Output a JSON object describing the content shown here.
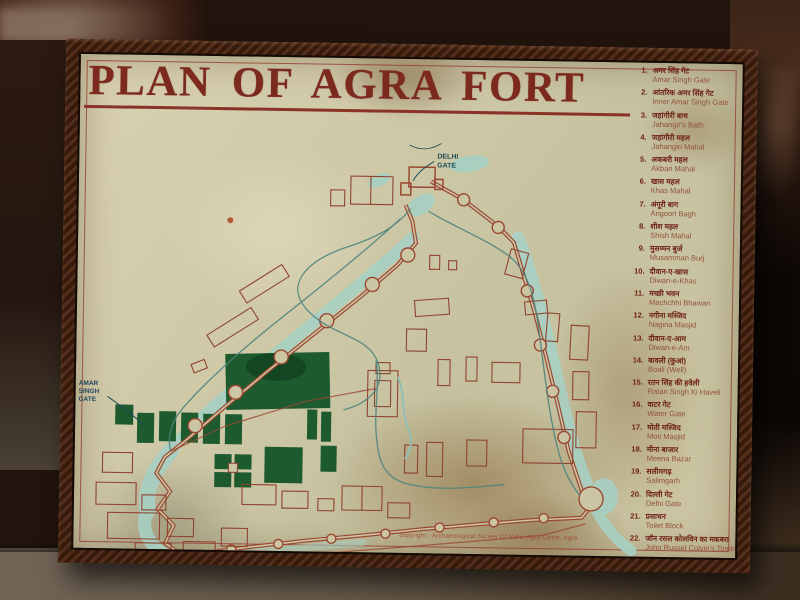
{
  "title": "PLAN OF AGRA FORT",
  "legend": {
    "items": [
      {
        "number": "1.",
        "hindi": "अमर सिंह गेट",
        "english": "Amar Singh Gate"
      },
      {
        "number": "2.",
        "hindi": "आंतरिक अमर सिंह गेट",
        "english": "Inner Amar Singh Gate"
      },
      {
        "number": "3.",
        "hindi": "जहांगीरी बाथ",
        "english": "Jahangir's Bath"
      },
      {
        "number": "4.",
        "hindi": "जहांगीरी महल",
        "english": "Jahangiri Mahal"
      },
      {
        "number": "5.",
        "hindi": "अकबरी महल",
        "english": "Akbari Mahal"
      },
      {
        "number": "6.",
        "hindi": "खास महल",
        "english": "Khas Mahal"
      },
      {
        "number": "7.",
        "hindi": "अंगूरी बाग",
        "english": "Angoori Bagh"
      },
      {
        "number": "8.",
        "hindi": "शीश महल",
        "english": "Shish Mahal"
      },
      {
        "number": "9.",
        "hindi": "मुसम्मन बुर्ज",
        "english": "Musamman Burj"
      },
      {
        "number": "10.",
        "hindi": "दीवान-ए-खास",
        "english": "Diwan-e-Khas"
      },
      {
        "number": "11.",
        "hindi": "मच्छी भवन",
        "english": "Machchhi Bhawan"
      },
      {
        "number": "12.",
        "hindi": "नगीना मस्जिद",
        "english": "Nagina Masjid"
      },
      {
        "number": "13.",
        "hindi": "दीवान-ए-आम",
        "english": "Diwan-e-Am"
      },
      {
        "number": "14.",
        "hindi": "बावली (कुआं)",
        "english": "Boali (Well)"
      },
      {
        "number": "15.",
        "hindi": "रतन सिंह की हवेली",
        "english": "Ratan Singh Ki Haveli"
      },
      {
        "number": "16.",
        "hindi": "वाटर गेट",
        "english": "Water Gate"
      },
      {
        "number": "17.",
        "hindi": "मोती मस्जिद",
        "english": "Moti Masjid"
      },
      {
        "number": "18.",
        "hindi": "मीना बाजार",
        "english": "Meena Bazar"
      },
      {
        "number": "19.",
        "hindi": "सलीमगढ़",
        "english": "Salimgarh"
      },
      {
        "number": "20.",
        "hindi": "दिल्ली गेट",
        "english": "Delhi Gate"
      },
      {
        "number": "21.",
        "hindi": "प्रसाधन",
        "english": "Toilet Block"
      },
      {
        "number": "22.",
        "hindi": "जॉन रसल कोलविन का मकबरा",
        "english": "John Russel Colvin's Tomb"
      }
    ]
  },
  "map": {
    "labels": {
      "delhi_gate": [
        "DELHI",
        "GATE"
      ],
      "amar_singh_gate": [
        "AMAR",
        "SINGH",
        "GATE"
      ]
    }
  },
  "footer": {
    "copyright": "copyright : Archaeological Survey Of India, Agra Circle, Agra"
  },
  "colors": {
    "title_text": "#7c2a1e",
    "legend_hindi": "#6e1f14",
    "legend_english": "#92503a",
    "sign_face": "#cfc9a8",
    "frame_wood": "#42200f",
    "fort_wall": "#9a4832",
    "moat_water": "#a7d0c3",
    "garden_green": "#1d5a2d",
    "road_line": "#4d837d",
    "map_label_text": "#1d4c55",
    "marker_dot": "#b45a3c"
  }
}
